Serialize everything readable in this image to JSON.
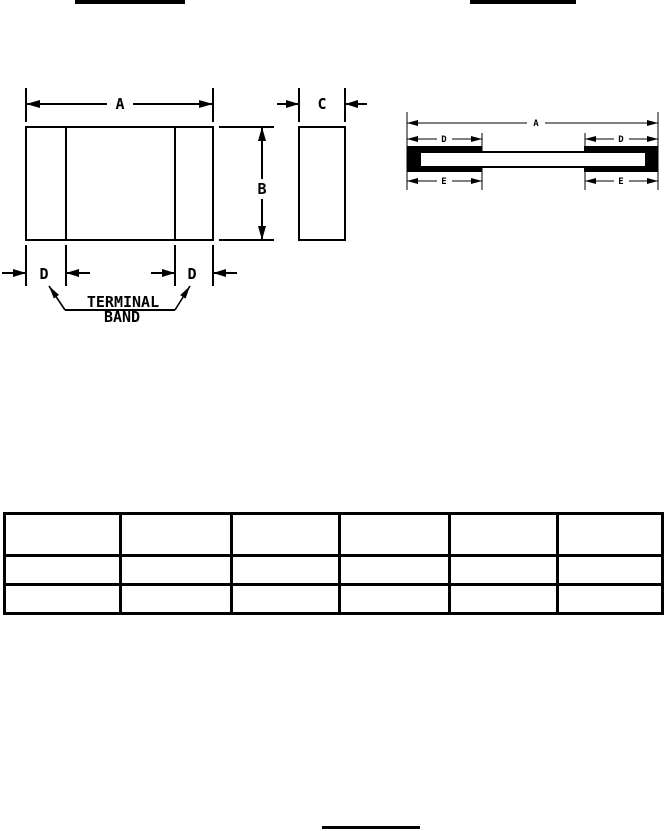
{
  "colors": {
    "ink": "#000000",
    "paper": "#ffffff"
  },
  "figures": {
    "front_view": {
      "dim_a": "A",
      "dim_b": "B",
      "dim_c": "C",
      "dim_d_left": "D",
      "dim_d_right": "D",
      "callout": {
        "line1": "TERMINAL",
        "line2": "BAND"
      }
    },
    "section_view": {
      "dim_a": "A",
      "dim_d_left": "D",
      "dim_d_right": "D",
      "dim_e_left": "E",
      "dim_e_right": "E"
    }
  },
  "table": {
    "columns": [
      "",
      "",
      "",
      "",
      "",
      ""
    ],
    "rows": [
      [
        "",
        "",
        "",
        "",
        "",
        ""
      ],
      [
        "",
        "",
        "",
        "",
        "",
        ""
      ]
    ]
  }
}
